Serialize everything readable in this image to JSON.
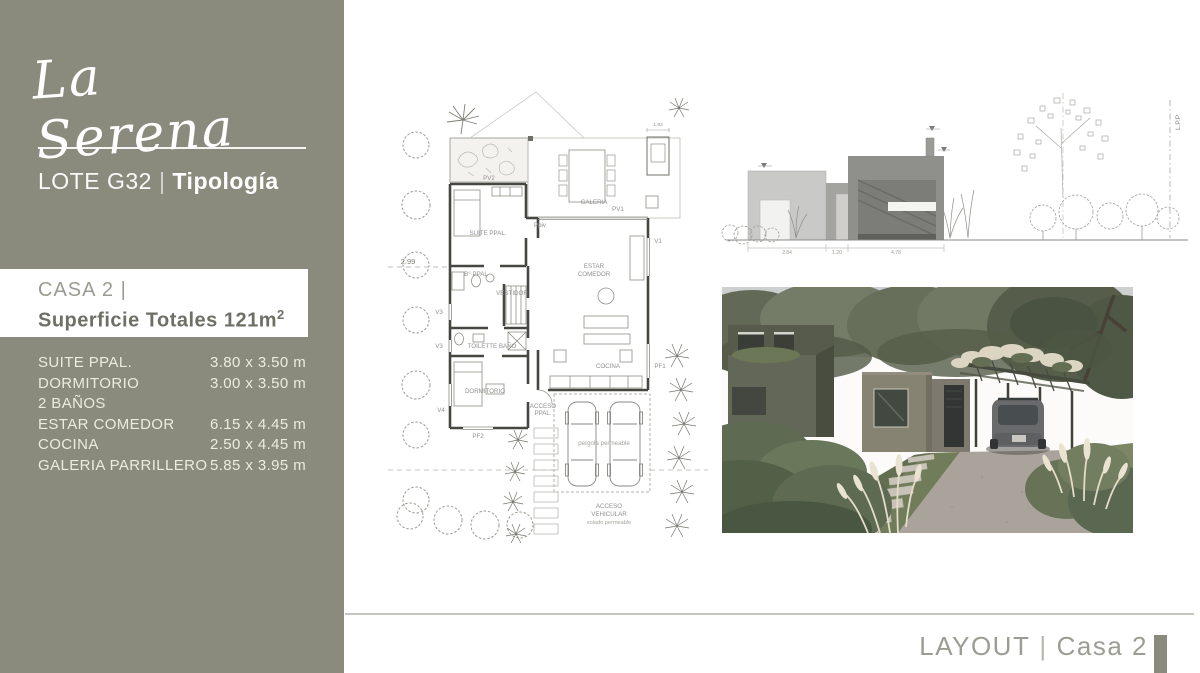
{
  "colors": {
    "sidebar_bg": "#8A8B7D",
    "accent_bar": "#8A8B7D",
    "footer_text": "#9C9D92",
    "casa_title_text": "#9A9B90",
    "casa_subtitle_text": "#6E6F65"
  },
  "sidebar": {
    "brand": "La Serena",
    "lot": "LOTE G32",
    "lot_sep": "|",
    "type": "Tipología",
    "casa": {
      "title": "CASA 2 |",
      "subtitle": "Superficie Totales 121m",
      "sup": "2"
    },
    "rooms": [
      {
        "name": "SUITE PPAL.",
        "dim": "3.80 x 3.50 m"
      },
      {
        "name": "DORMITORIO",
        "dim": "3.00 x 3.50 m"
      },
      {
        "name": "2 BAÑOS",
        "dim": ""
      },
      {
        "name": "ESTAR COMEDOR",
        "dim": "6.15 x 4.45 m"
      },
      {
        "name": "COCINA",
        "dim": "2.50 x 4.45 m"
      },
      {
        "name": "GALERIA PARRILLERO",
        "dim": "5.85 x 3.95 m"
      }
    ]
  },
  "floorplan": {
    "labels": {
      "pv2": "PV2",
      "suite": "SUITE PPAL.",
      "b_ppal": "B° PPAL",
      "vestidor": "VESTIDOR",
      "galeria": "GALERIA",
      "pv1": "PV1",
      "estar1": "ESTAR",
      "estar2": "COMEDOR",
      "toilette": "TOILETTE BAÑO",
      "dormitorio": "DORMITORIO",
      "cocina": "COCINA",
      "acceso1": "ACCESO",
      "acceso2": "PPAL.",
      "pergola": "pergola permeable",
      "veh1": "ACCESO",
      "veh2": "VEHICULAR",
      "veh3": "solado permeable",
      "v1": "V1",
      "v3a": "V3",
      "v3b": "V3",
      "v4": "V4",
      "pf1": "PF1",
      "pf2": "PF2",
      "ppiv": "Ppiv",
      "setback": "2.99",
      "dim_top": "1.93"
    }
  },
  "elevation": {
    "lpp": "L.P.P",
    "dims": [
      "2.84",
      "1.20",
      "4.78"
    ]
  },
  "footer": {
    "label": "LAYOUT",
    "separator": "|",
    "value": "Casa 2"
  }
}
